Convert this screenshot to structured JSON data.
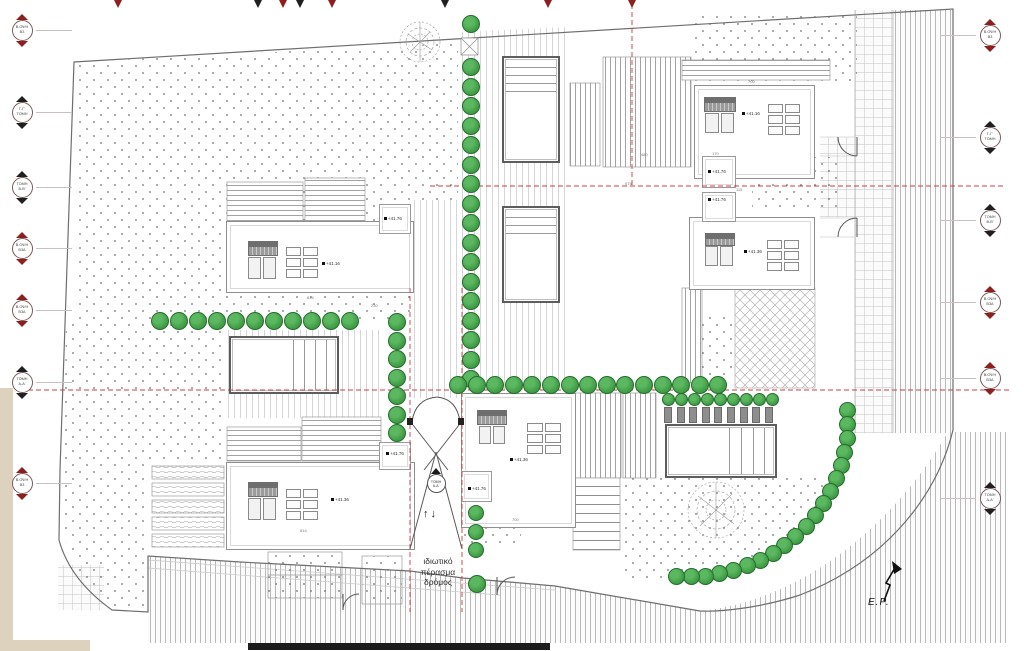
{
  "road_label": {
    "lines": [
      "ιδιωτικό",
      "πέρασμα",
      "δρόμος"
    ]
  },
  "north": {
    "label": "E.P."
  },
  "ramp": {
    "arrows": "↑↓",
    "marker_line1": "ΤΟΜΗ",
    "marker_line2": "Α-Α'"
  },
  "colors": {
    "tree_fill": "#46a24a",
    "tree_edge": "#256e2e",
    "red_line": "#c94040",
    "marker_red": "#8e1f1f",
    "marker_black": "#1f1f1f",
    "stair_gray": "#8e8e8e"
  },
  "markers": {
    "left": [
      {
        "y": 30,
        "color": "red",
        "line1": "Β.ΟΨΗ",
        "line2": "Β3"
      },
      {
        "y": 112,
        "color": "black",
        "line1": "Γ-Γ'",
        "line2": "ΤΟΜΗ"
      },
      {
        "y": 187,
        "color": "black",
        "line1": "ΤΟΜΗ",
        "line2": "Β-Β'"
      },
      {
        "y": 248,
        "color": "red",
        "line1": "Β.ΟΨΗ",
        "line2": "Β3Α"
      },
      {
        "y": 310,
        "color": "red",
        "line1": "Β.ΟΨΗ",
        "line2": "Β3Α"
      },
      {
        "y": 382,
        "color": "black",
        "line1": "ΤΟΜΗ",
        "line2": "Α-Α'"
      },
      {
        "y": 483,
        "color": "red",
        "line1": "Β.ΟΨΗ",
        "line2": "Β3"
      }
    ],
    "right": [
      {
        "y": 35,
        "color": "red",
        "line1": "Β.ΟΨΗ",
        "line2": "Β3"
      },
      {
        "y": 137,
        "color": "black",
        "line1": "Γ-Γ'",
        "line2": "ΤΟΜΗ"
      },
      {
        "y": 220,
        "color": "black",
        "line1": "ΤΟΜΗ",
        "line2": "Β-Β'"
      },
      {
        "y": 302,
        "color": "red",
        "line1": "Β.ΟΨΗ",
        "line2": "Β3Α"
      },
      {
        "y": 378,
        "color": "red",
        "line1": "Β.ΟΨΗ",
        "line2": "Β3Α"
      },
      {
        "y": 498,
        "color": "black",
        "line1": "ΤΟΜΗ",
        "line2": "Α-Α'"
      }
    ]
  },
  "top_flags": [
    {
      "x": 118,
      "color": "red"
    },
    {
      "x": 258,
      "color": "black"
    },
    {
      "x": 283,
      "color": "red"
    },
    {
      "x": 300,
      "color": "black"
    },
    {
      "x": 332,
      "color": "red"
    },
    {
      "x": 445,
      "color": "black"
    },
    {
      "x": 548,
      "color": "red"
    },
    {
      "x": 632,
      "color": "red"
    }
  ],
  "elevations": [
    {
      "text": "+41.16",
      "x": 322,
      "y": 261
    },
    {
      "text": "+41.76",
      "x": 384,
      "y": 216
    },
    {
      "text": "+41.36",
      "x": 331,
      "y": 497
    },
    {
      "text": "+41.76",
      "x": 386,
      "y": 451
    },
    {
      "text": "+41.36",
      "x": 510,
      "y": 457
    },
    {
      "text": "+41.76",
      "x": 468,
      "y": 486
    },
    {
      "text": "+41.16",
      "x": 742,
      "y": 111
    },
    {
      "text": "+41.76",
      "x": 708,
      "y": 169
    },
    {
      "text": "+41.76",
      "x": 708,
      "y": 197
    },
    {
      "text": "+41.36",
      "x": 744,
      "y": 249
    }
  ],
  "dimensions": [
    {
      "text": "700",
      "x": 748,
      "y": 79
    },
    {
      "text": "115",
      "x": 736,
      "y": 187
    },
    {
      "text": "170",
      "x": 712,
      "y": 151
    },
    {
      "text": "480",
      "x": 641,
      "y": 152
    },
    {
      "text": "575",
      "x": 625,
      "y": 181
    },
    {
      "text": "814",
      "x": 307,
      "y": 295
    },
    {
      "text": "230",
      "x": 371,
      "y": 303
    },
    {
      "text": "814",
      "x": 300,
      "y": 528
    },
    {
      "text": "700",
      "x": 512,
      "y": 517
    }
  ],
  "trees": {
    "rows": [
      {
        "x": 471,
        "y": 67,
        "dx": 0,
        "dy": 19.5,
        "count": 17,
        "r": 9
      },
      {
        "x": 160,
        "y": 321,
        "dx": 19,
        "dy": 0,
        "count": 11,
        "r": 9
      },
      {
        "x": 397,
        "y": 322,
        "dx": 0,
        "dy": 18.5,
        "count": 7,
        "r": 9
      },
      {
        "x": 458,
        "y": 385,
        "dx": 18.6,
        "dy": 0,
        "count": 15,
        "r": 9
      },
      {
        "x": 668,
        "y": 399,
        "dx": 13,
        "dy": 0,
        "count": 9,
        "r": 6.5
      },
      {
        "x": 476,
        "y": 513,
        "dx": 0,
        "dy": 18.5,
        "count": 3,
        "r": 8
      }
    ],
    "singles": [
      {
        "x": 471,
        "y": 24,
        "r": 9
      },
      {
        "x": 477,
        "y": 584,
        "r": 9
      }
    ],
    "arc": {
      "cx": 688,
      "cy": 421,
      "rx": 160,
      "ry": 156,
      "start": -4,
      "end": 94,
      "count": 20,
      "r": 8.5
    }
  },
  "parking_posts": {
    "x": 664,
    "y": 407,
    "w": 8,
    "h": 16,
    "dx": 12.6,
    "count": 9
  }
}
